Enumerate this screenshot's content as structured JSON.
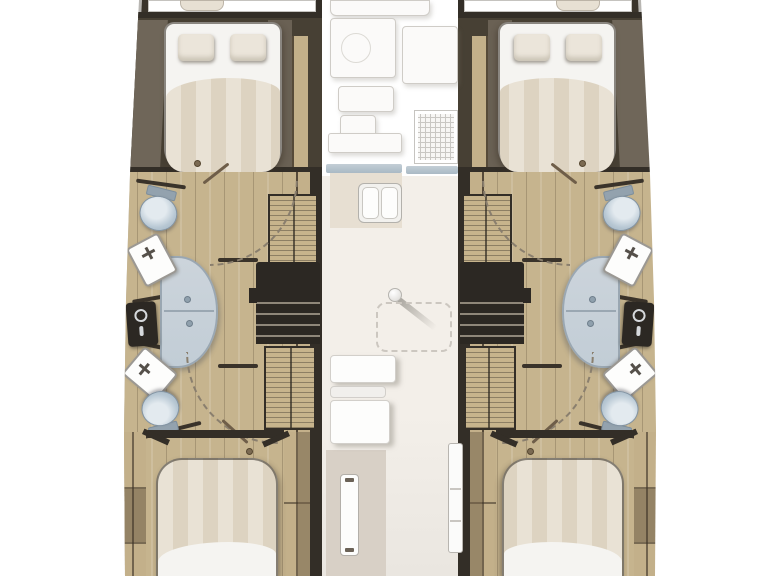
{
  "meta": {
    "type": "floorplan",
    "subject": "Catamaran yacht interior deck plan, top view",
    "orientation": "bow-up",
    "hull_count": 2,
    "cabin_count": 4,
    "head_count": 4
  },
  "areas": {
    "port_hull": {
      "label": "Port hull",
      "rooms": [
        {
          "label": "Forward cabin",
          "fixtures": [
            "Double berth",
            "Two pillows",
            "Side lockers"
          ]
        },
        {
          "label": "Forward head",
          "fixtures": [
            "Toilet",
            "Washbasin",
            "Shower stall"
          ]
        },
        {
          "label": "Midship",
          "fixtures": [
            "Wardrobe locker",
            "Companionway steps",
            "Shower column"
          ]
        },
        {
          "label": "Aft head",
          "fixtures": [
            "Washbasin",
            "Toilet",
            "Wardrobe locker"
          ]
        },
        {
          "label": "Aft cabin",
          "fixtures": [
            "Double berth"
          ]
        }
      ]
    },
    "starboard_hull": {
      "label": "Starboard hull (mirror of port)",
      "rooms": [
        {
          "label": "Forward cabin",
          "fixtures": [
            "Double berth",
            "Two pillows",
            "Side lockers"
          ]
        },
        {
          "label": "Forward head",
          "fixtures": [
            "Toilet",
            "Washbasin",
            "Shower stall"
          ]
        },
        {
          "label": "Midship",
          "fixtures": [
            "Wardrobe locker",
            "Companionway steps",
            "Shower column"
          ]
        },
        {
          "label": "Aft head",
          "fixtures": [
            "Washbasin",
            "Toilet",
            "Wardrobe locker"
          ]
        },
        {
          "label": "Aft cabin",
          "fixtures": [
            "Double berth"
          ]
        }
      ]
    },
    "saloon": {
      "label": "Bridgedeck saloon and galley",
      "fixtures": [
        "Galley counter",
        "Worktop with ring",
        "Stove top grid",
        "Counter edges",
        "Double sink",
        "Mast post",
        "Folded table",
        "Nav seat blocks",
        "Companionway door",
        "Sliding door panel"
      ]
    }
  },
  "fixture_titles": {
    "hull_port": "Port hull",
    "hull_starboard": "Starboard hull",
    "foredeck": "Foredeck panel",
    "cushion": "Deck cushion",
    "fwd_cabin": "Forward cabin",
    "bed": "Double berth",
    "pillow": "Pillow",
    "duvet": "Striped duvet",
    "floor": "Teak cabin sole",
    "toilet": "Toilet",
    "basin": "Washbasin",
    "shower": "Shower stall",
    "shower_col": "Shower column",
    "wardrobe": "Wardrobe locker",
    "steps": "Companionway steps",
    "door_arc": "Door swing",
    "door_rod": "Door leaf",
    "aft_cabin": "Aft cabin",
    "saloon": "Saloon",
    "galley": "Galley unit",
    "stove": "Stove top",
    "counter_edge": "Counter edge",
    "double_sink": "Double sink",
    "mast": "Mast post",
    "table": "Saloon table (stowed)",
    "seat": "Saloon seat",
    "door": "Companionway door",
    "side_door": "Sliding door panel"
  },
  "theme": {
    "colors": {
      "bg": "#ffffff",
      "hull-outline": "#b8b6b2",
      "wall-dark": "#3a342b",
      "wall-darker": "#332e27",
      "cabin-dark": "#474034",
      "panel-taupe": "#6f6659",
      "wood-a": "#c6b48e",
      "wood-b": "#c7b48c",
      "wood-side": "#c3b08a",
      "bed-sheet": "#f5f4f1",
      "bed-stripe-a": "#e9e2d5",
      "bed-stripe-b": "#ddd3c1",
      "pillow": "#ebe5da",
      "cushion": "#e7e0d3",
      "toilet": "#b7c7d3",
      "toilet-dark": "#93a2ae",
      "shower-glass": "#c2cdd6",
      "shower-knob": "#8fa0ad",
      "fixture-white": "#fdfdfc",
      "fixture-outline": "#9b9893",
      "galley-white": "#fbfaf9",
      "galley-outline": "#cfccc7",
      "counter-edge": "#a9b9c4",
      "counter-beige": "#e7dfd2",
      "saloon-floor": "#f3efe9",
      "floor-lower": "#eae6e0",
      "panel-bottom": "#d8d0c6",
      "dashed-line": "#ccc7c0",
      "arc-dash": "#8a7f6e",
      "steps-dark": "#2c2823",
      "step-tread": "#8f8779",
      "partition": "#3a332a"
    }
  }
}
